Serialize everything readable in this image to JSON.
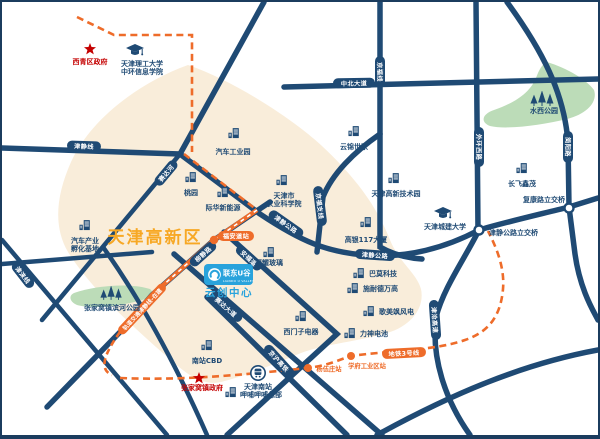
{
  "zone_title": "天津高新区",
  "logo": {
    "brand": "联东U谷",
    "brand_en": "LIANDO U VALLEY",
    "center": "云创中心"
  },
  "roads": {
    "jinjing_line": "津静线",
    "zhongbei": "中北大道",
    "jingfu": "京福线",
    "waihuan_west": "外环西路",
    "jianyang": "简阳路",
    "jingfu_branch": "京福支线",
    "jinjing_hwy_a": "津静公路",
    "jinjing_hwy_b": "津静公路",
    "jincang": "津沧高速",
    "jinghu": "京沪高铁",
    "anfu": "安福道",
    "saida_ave": "赛达大道",
    "liujing": "柳静路",
    "saida_river": "赛达河",
    "jinlai": "津涞线"
  },
  "interchanges": {
    "jinjing": "津静公路立交桥",
    "fukang": "复康路立交桥"
  },
  "metro": {
    "line3": "地铁3号线",
    "construction": "轨道交通津静线-在建",
    "station_fuandao": "福安道站",
    "station_yangwuzhuang": "杨伍庄站",
    "station_xuefu": "学府工业区站"
  },
  "government": {
    "xiqing": "西青区政府",
    "zhangjiawo": "张家窝镇政府"
  },
  "education": {
    "tjut_l1": "天津理工大学",
    "tjut_l2": "中环信息学院",
    "chengjian": "天津城建大学"
  },
  "parks": {
    "shuixi": "水西公园",
    "binhe": "张家窝镇滨河公园"
  },
  "station": {
    "tianjin_south": "天津南站"
  },
  "pois": {
    "auto_park": "汽车工业园",
    "taoyuan": "桃园",
    "jihua": "际华新能源",
    "agri_l1": "天津市",
    "agri_l2": "农业科学院",
    "yunjin": "云锦世家",
    "hitech": "天津高新技术园",
    "changfei": "长飞鑫茂",
    "goldin": "高银117大厦",
    "fuyao": "福耀玻璃",
    "bamo": "巴莫科技",
    "schneider": "施耐德万高",
    "gamesa": "歌美飒风电",
    "lishen": "力神电池",
    "siemens": "西门子电器",
    "incubator_l1": "汽车产业",
    "incubator_l2": "孵化基地",
    "nanzhan_cbd": "南站CBD",
    "xiabu": "呷哺呷哺总部"
  }
}
